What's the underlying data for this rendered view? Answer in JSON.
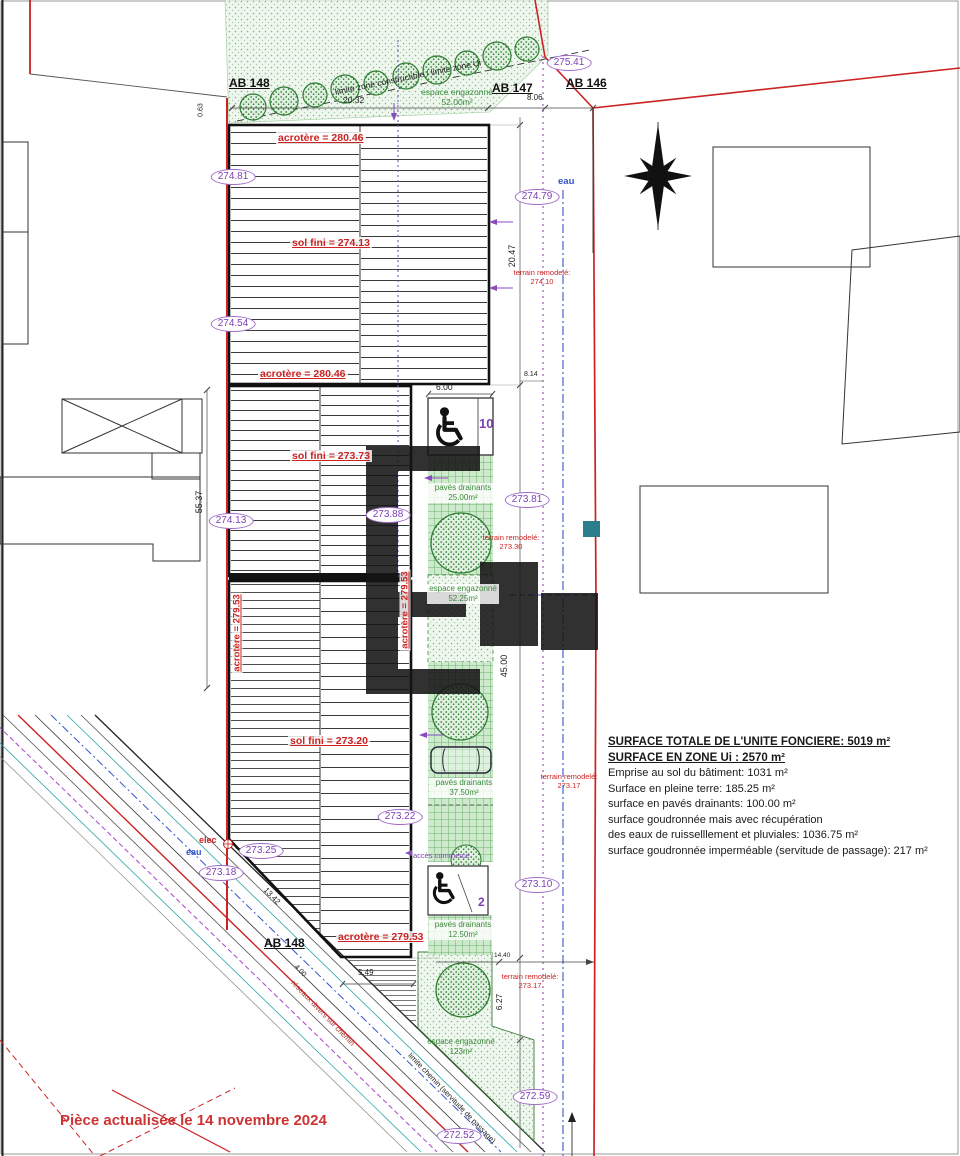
{
  "parcels": {
    "top_left": "AB 148",
    "top_mid": "AB 147",
    "top_right": "AB 146",
    "bottom": "AB 148"
  },
  "limits": {
    "zone": "limite zone constructible / limite zone Ui",
    "chemin": "limite chemin (servitude de passage)",
    "reseaux": "réseaux divers sur chemin"
  },
  "levels": [
    "275.41",
    "274.81",
    "274.79",
    "274.54",
    "274.13",
    "273.88",
    "273.81",
    "273.25",
    "273.22",
    "273.18",
    "273.10",
    "272.59",
    "272.52"
  ],
  "building": {
    "acrotere_a": "acrotère = 280.46",
    "acrotere_a2": "acrotère = 280.46",
    "acrotere_b_left": "acrotère = 279.53",
    "acrotere_b_right": "acrotère = 279.53",
    "acrotere_b_bottom": "acrotère = 279.53",
    "sol_fini_1": "sol fini = 274.13",
    "sol_fini_2": "sol fini = 273.73",
    "sol_fini_3": "sol fini = 273.20"
  },
  "terrain": {
    "label": "terrain remodelé:",
    "v1": "274.10",
    "v2": "273.30",
    "v3": "273.17",
    "v4": "273.17"
  },
  "green": {
    "strip_label": "espace engazonné",
    "strip_area": "52.00m²",
    "mid_label": "espace engazonné",
    "mid_area": "52.25m²",
    "bottom_label": "espace engazonné",
    "bottom_area": "123m²",
    "paves1_label": "pavés drainants",
    "paves1_area": "25.00m²",
    "paves2_label": "pavés drainants",
    "paves2_area": "37.50m²",
    "paves3_label": "pavés drainants",
    "paves3_area": "12.50m²"
  },
  "utilities": {
    "eau_top": "eau",
    "eau_left": "eau",
    "elec": "elec"
  },
  "parking": {
    "access_label": "accès commerce",
    "count_top": "10",
    "count_bottom": "2"
  },
  "dims": {
    "d1": "20.32",
    "d2": "8.06",
    "d3": "0.63",
    "d4": "20.47",
    "d5": "8.14",
    "d6": "6.00",
    "d7": "55.37",
    "d8": "45.00",
    "d9": "5.49",
    "d10": "13.42",
    "d11": "4.00",
    "d12": "14.40",
    "d13": "6.27"
  },
  "surfaces": {
    "l1": "SURFACE TOTALE DE L'UNITE FONCIERE: 5019 m²",
    "l2": "SURFACE EN ZONE Ui : 2570 m²",
    "l3": "Emprise au sol du bâtiment: 1031 m²",
    "l4": "Surface en pleine terre: 185.25 m²",
    "l5": "surface en pavés drainants: 100.00 m²",
    "l6": "surface goudronnée mais avec récupération",
    "l7": "des eaux de ruisselllement et pluviales: 1036.75 m²",
    "l8": "surface goudronnée imperméable (servitude de passage): 217 m²"
  },
  "note": {
    "date": "Pièce actualisée le 14 novembre 2024"
  },
  "colors": {
    "boundary_red": "#cc2222",
    "level_purple": "#8a4bbf",
    "green": "#3a8a3a",
    "blue": "#3355cc",
    "teal_marker": "#2a7f8a"
  }
}
